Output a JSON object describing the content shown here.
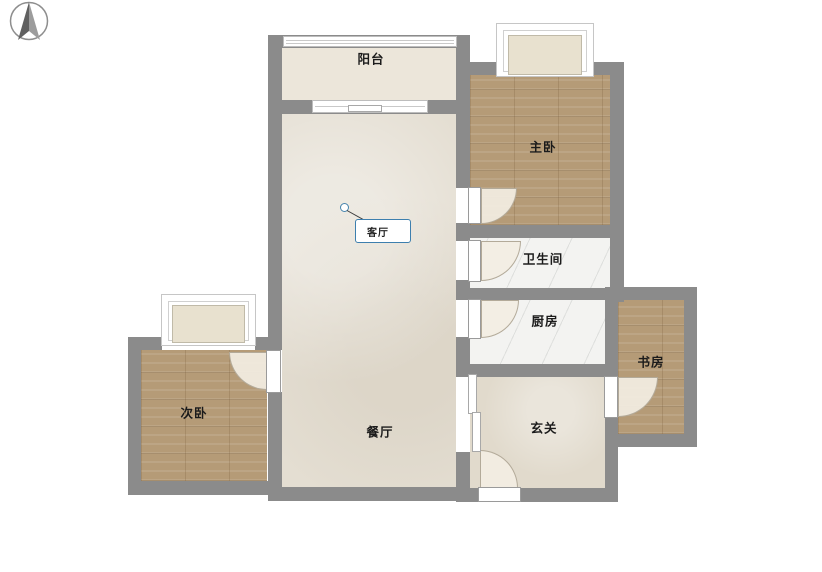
{
  "compass": {
    "icon": "north-arrow"
  },
  "rooms": {
    "balcony": {
      "label": "阳台"
    },
    "master_bedroom": {
      "label": "主卧"
    },
    "living_room": {
      "label": "客厅"
    },
    "bathroom": {
      "label": "卫生间"
    },
    "kitchen": {
      "label": "厨房"
    },
    "study": {
      "label": "书房"
    },
    "second_bedroom": {
      "label": "次卧"
    },
    "dining_room": {
      "label": "餐厅"
    },
    "entrance": {
      "label": "玄关"
    }
  },
  "callout": {
    "room": "living_room"
  },
  "colors": {
    "wall": "#8b8b8b",
    "wood_floor": "#b59b77",
    "tile_floor": "#e4ded2",
    "marble_floor": "#f3f3f1",
    "balcony_floor": "#ece6da",
    "bay_window_fill": "#e8e1cf",
    "callout_border": "#3d7fae"
  }
}
